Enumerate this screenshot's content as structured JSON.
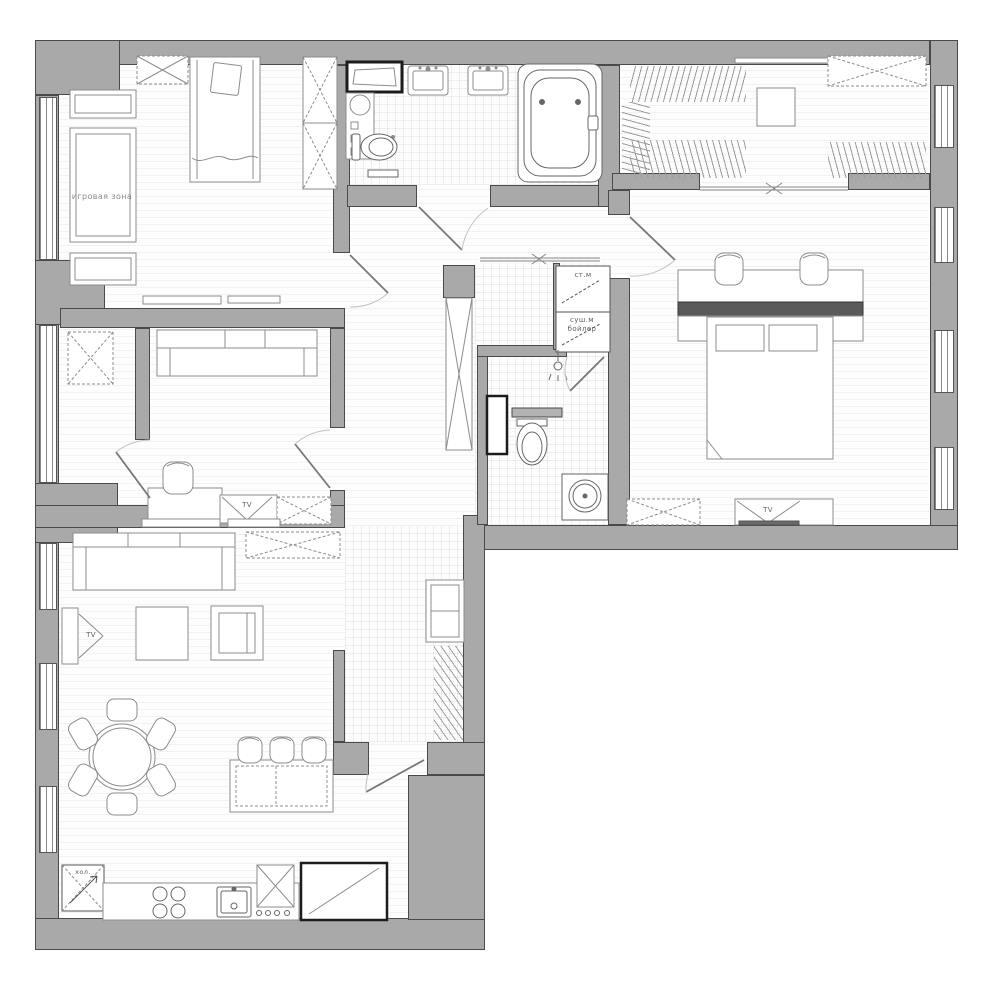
{
  "labels": {
    "play_zone": "игровая зона",
    "washer": "ст.м",
    "dryer_boiler": "суш.м\nбойлер",
    "tv": "TV",
    "fridge": "хол."
  },
  "colors": {
    "wall_fill": "#a9a9a9",
    "wall_outline": "#4a4a4a",
    "floor": "#fdfdfd",
    "furniture_line": "#8c8c8c",
    "sanitary_line": "#666666",
    "accent_dark": "#555555"
  }
}
